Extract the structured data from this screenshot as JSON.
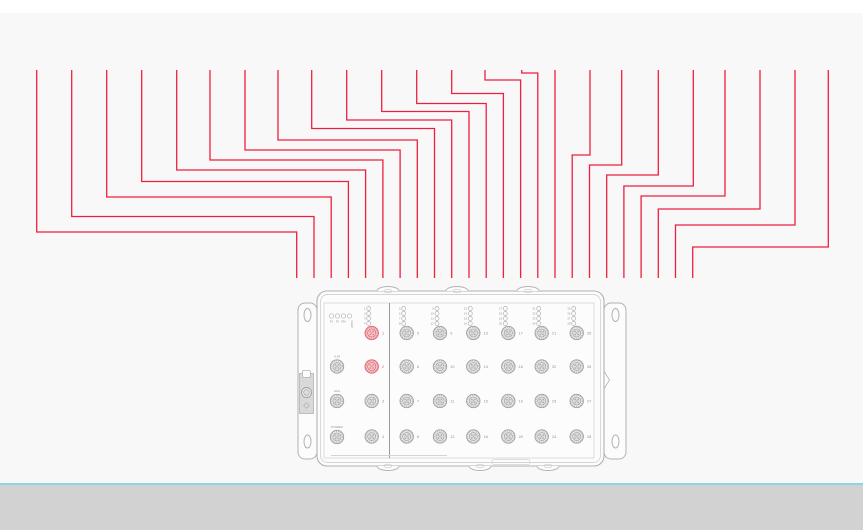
{
  "colors": {
    "page_top": "#ffffff",
    "canvas_bg": "#f8f8f8",
    "wire": "#ee1f40",
    "edge_line": "#8fd4e3",
    "bottom_bar": "#d2d2d2",
    "device_stroke": "#b2b2b2",
    "device_stroke_light": "#d4d4d4",
    "device_fill": "#fcfcfc",
    "divider_stroke": "#9a9a9a",
    "port_stroke": "#9e9e9e",
    "port_fill": "#ededed",
    "port_fill_inner": "#dedede",
    "pin_fill": "#b0b0b0",
    "label_color": "#8f8f8f",
    "highlight_stroke": "#e06070",
    "highlight_fill": "#f6c5c9",
    "highlight_pin": "#e08890",
    "bracket_fill": "#d9d9d9"
  },
  "wiring": {
    "top_y": 70,
    "end_y": 278,
    "wire_width": 1.3,
    "wires": [
      {
        "from_x": 36.7,
        "jog_y": 232,
        "to_x": 296.7
      },
      {
        "from_x": 71.7,
        "jog_y": 216.5,
        "to_x": 314.0
      },
      {
        "from_x": 106.7,
        "jog_y": 197,
        "to_x": 331.2
      },
      {
        "from_x": 141.7,
        "jog_y": 181.5,
        "to_x": 348.4
      },
      {
        "from_x": 176.7,
        "jog_y": 170,
        "to_x": 365.6
      },
      {
        "from_x": 210.0,
        "jog_y": 160,
        "to_x": 382.9
      },
      {
        "from_x": 245.0,
        "jog_y": 150,
        "to_x": 400.1
      },
      {
        "from_x": 278.0,
        "jog_y": 140,
        "to_x": 417.3
      },
      {
        "from_x": 311.7,
        "jog_y": 128.5,
        "to_x": 434.5
      },
      {
        "from_x": 346.7,
        "jog_y": 120,
        "to_x": 451.7
      },
      {
        "from_x": 381.7,
        "jog_y": 111.5,
        "to_x": 469.0
      },
      {
        "from_x": 416.7,
        "jog_y": 103.5,
        "to_x": 486.2
      },
      {
        "from_x": 451.7,
        "jog_y": 93.5,
        "to_x": 503.4
      },
      {
        "from_x": 485.0,
        "jog_y": 80,
        "to_x": 520.6
      },
      {
        "from_x": 521.7,
        "jog_y": 73,
        "to_x": 537.8
      },
      {
        "from_x": 555.0,
        "jog_y": 70,
        "to_x": 555.0
      },
      {
        "from_x": 590.0,
        "jog_y": 155,
        "to_x": 572.2
      },
      {
        "from_x": 621.7,
        "jog_y": 165,
        "to_x": 589.5
      },
      {
        "from_x": 658.3,
        "jog_y": 175,
        "to_x": 606.7
      },
      {
        "from_x": 693.3,
        "jog_y": 186,
        "to_x": 623.9
      },
      {
        "from_x": 725.0,
        "jog_y": 196,
        "to_x": 641.1
      },
      {
        "from_x": 760.0,
        "jog_y": 209,
        "to_x": 658.3
      },
      {
        "from_x": 795.0,
        "jog_y": 225,
        "to_x": 675.5
      },
      {
        "from_x": 828.3,
        "jog_y": 247,
        "to_x": 692.7
      }
    ]
  },
  "device": {
    "status_leds": [
      "P1",
      "P2",
      "RM",
      "FAULT"
    ],
    "side_ports": [
      "V.24",
      "ACA",
      "POWER"
    ],
    "port_columns": [
      [
        1,
        2,
        3,
        4
      ],
      [
        5,
        6,
        7,
        8
      ],
      [
        9,
        10,
        11,
        12
      ],
      [
        13,
        14,
        15,
        16
      ],
      [
        17,
        18,
        19,
        20
      ],
      [
        21,
        22,
        23,
        24
      ],
      [
        25,
        26,
        27,
        28
      ]
    ],
    "highlighted_ports": [
      1,
      2
    ],
    "layout": {
      "body": {
        "x": 317,
        "y": 291,
        "w": 287,
        "h": 175
      },
      "panel": {
        "x": 324,
        "y": 303,
        "w": 270,
        "h": 155
      },
      "divider_x": 389.5,
      "flange_left": {
        "x": 298,
        "y": 303,
        "w": 19,
        "h": 156
      },
      "flange_right": {
        "x": 604,
        "y": 303,
        "w": 22,
        "h": 156
      },
      "screw_holes_y": [
        315,
        441.5
      ],
      "col_x": [
        371.7,
        406.7,
        440,
        473.3,
        508.3,
        541.7,
        576.7
      ],
      "row_y": [
        333,
        366.5,
        401,
        436.5
      ],
      "side_col_x": 337,
      "side_row_y": [
        366.5,
        401,
        437
      ],
      "led_row_y": [
        308.5,
        313.5,
        318.5,
        323.5
      ],
      "status_led_x": [
        331.5,
        337.5,
        343.5,
        349.5
      ],
      "status_led_y": 316,
      "bump_x_top": [
        388,
        457,
        528
      ],
      "bump_x_bottom": [
        388,
        480,
        548
      ],
      "label_strip": {
        "x1": 331,
        "x2": 447,
        "y": 455.5
      },
      "bottom_slot": {
        "x": 492,
        "y": 459.5,
        "w": 38,
        "h": 5
      }
    }
  }
}
